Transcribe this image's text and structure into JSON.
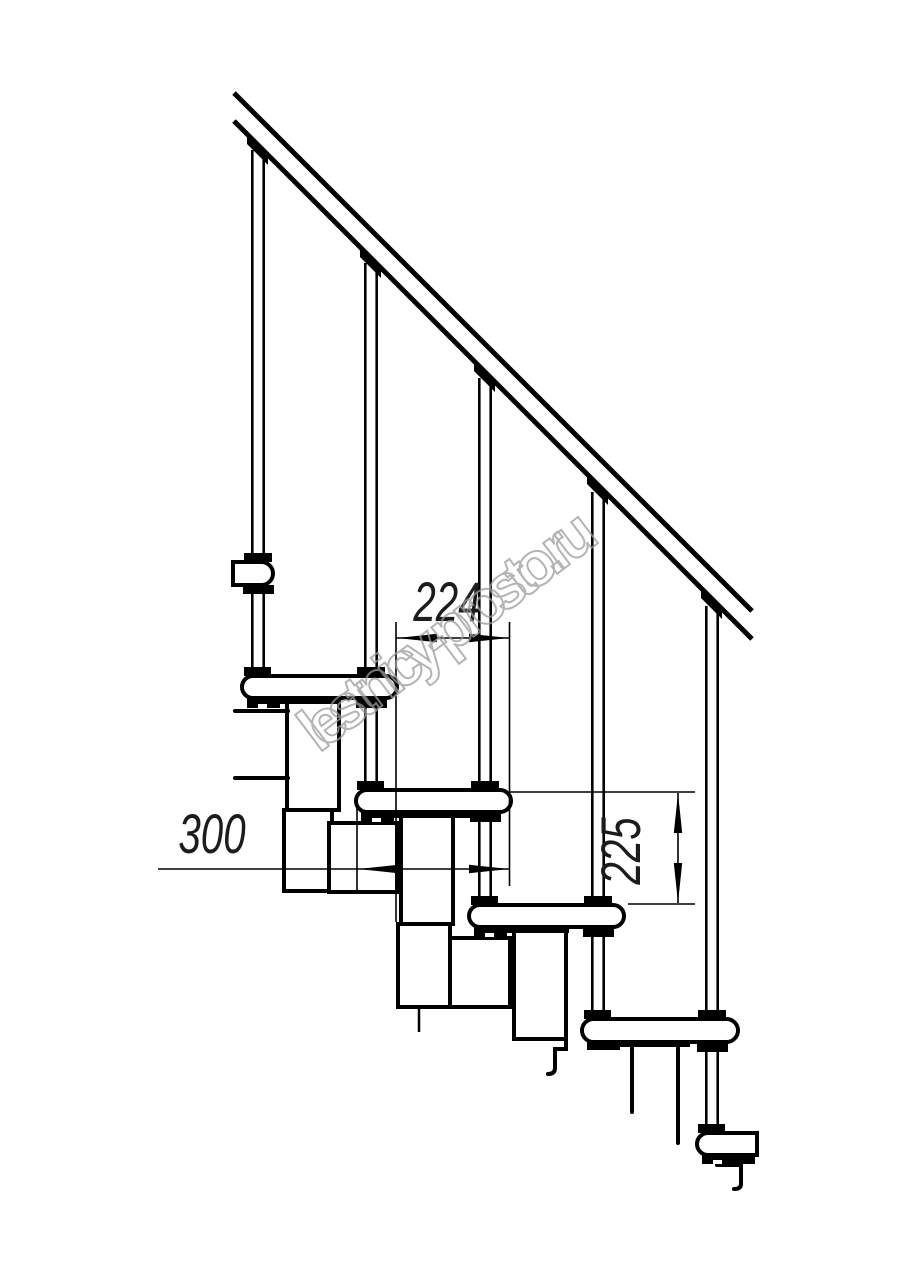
{
  "drawing": {
    "background": "#ffffff",
    "ink": "#000000"
  },
  "dimensions": {
    "step_run": {
      "value": "224"
    },
    "tread_depth": {
      "value": "300"
    },
    "step_rise": {
      "value": "225"
    }
  },
  "watermark": {
    "text": "lestnicy-prosto.ru",
    "color": "#9b9b9b"
  }
}
